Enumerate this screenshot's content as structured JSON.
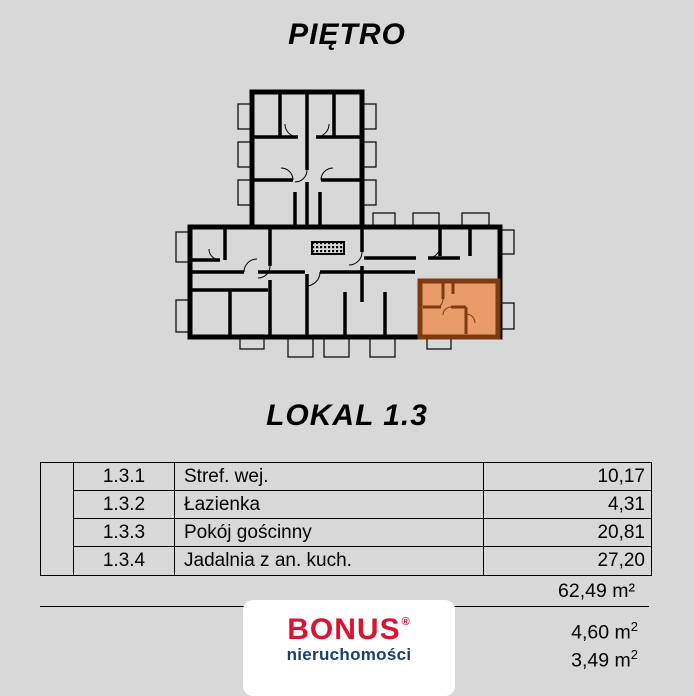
{
  "page": {
    "background": "#d8d8d8",
    "floor_title": "PIĘTRO",
    "unit_title": "LOKAL 1.3"
  },
  "floor_plan": {
    "wall_color": "#000000",
    "highlight_fill": "#e99c69",
    "highlight_wall": "#7a3c10",
    "highlighted_unit": "LOKAL 1.3"
  },
  "rooms_table": {
    "rows": [
      {
        "no": "1.3.1",
        "name": "Stref. wej.",
        "area": "10,17"
      },
      {
        "no": "1.3.2",
        "name": "Łazienka",
        "area": "4,31"
      },
      {
        "no": "1.3.3",
        "name": "Pokój gościnny",
        "area": "20,81"
      },
      {
        "no": "1.3.4",
        "name": "Jadalnia z an. kuch.",
        "area": "27,20"
      }
    ]
  },
  "totals": {
    "total_area": "62,49 m²",
    "extra_areas": [
      {
        "value": "4,60 m",
        "sup": "2"
      },
      {
        "value": "3,49 m",
        "sup": "2"
      }
    ]
  },
  "logo": {
    "brand": "BONUS",
    "registered_mark": "®",
    "subtitle": "nieruchomości",
    "brand_color": "#d81430",
    "subtitle_color": "#1a3f70"
  }
}
